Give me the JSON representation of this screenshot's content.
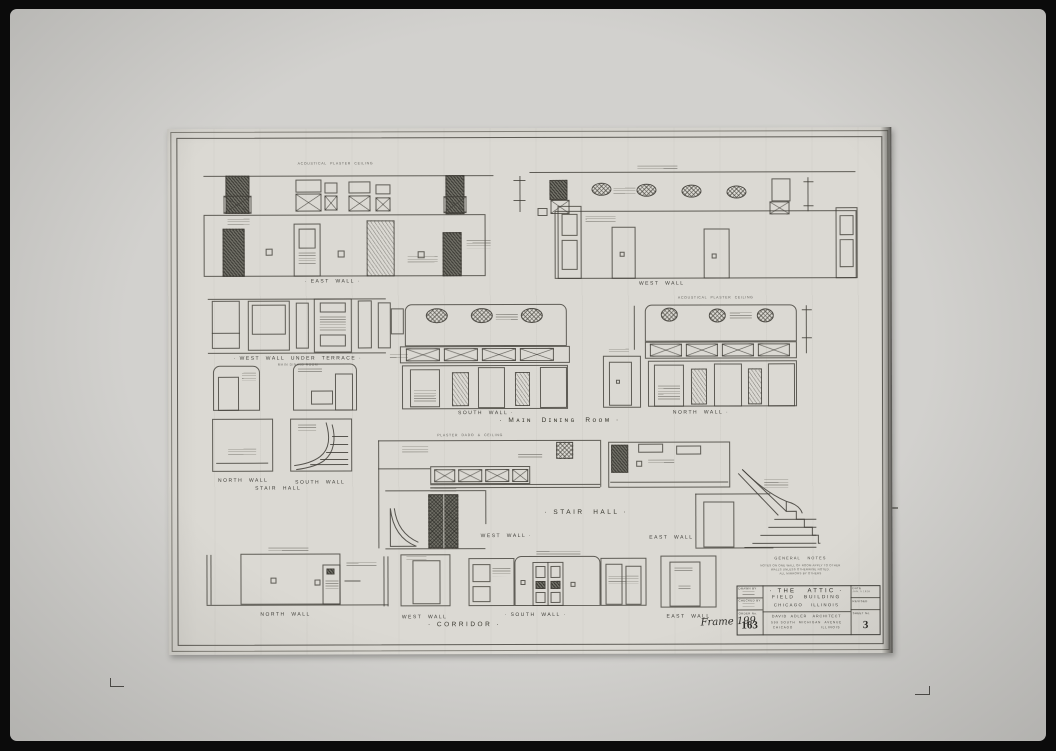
{
  "colors": {
    "photo_frame": "#0b0b0b",
    "photo_field": "#d2d1ce",
    "sheet_paper": "#dbd9d3",
    "ink": "#3e3d38"
  },
  "drawings": {
    "main_dining_room": {
      "title": "· Mᴀɪɴ  Dɪɴɪɴɢ  Rᴏᴏᴍ ·",
      "east_wall": "· EAST  WALL ·",
      "west_wall": "WEST  WALL",
      "west_wall_under_terrace": "· WEST  WALL  UNDER  TERRACE ·",
      "west_wall_under_terrace_sub": "MAIN DINING ROOM",
      "south_wall": "SOUTH  WALL ·",
      "north_wall": "NORTH  WALL ·"
    },
    "stair_hall": {
      "title": "· STAIR  HALL ·",
      "small_title": "STAIR  HALL",
      "north_wall": "NORTH  WALL",
      "south_wall": "SOUTH  WALL",
      "west_wall": "WEST  WALL ·",
      "east_wall": "EAST  WALL"
    },
    "corridor": {
      "title": "· CORRIDOR ·",
      "north_wall": "NORTH  WALL",
      "west_wall": "WEST  WALL",
      "south_wall": "· SOUTH  WALL ·",
      "east_wall": "EAST  WALL"
    }
  },
  "annotations": {
    "acoustical_ceiling": "ACOUSTICAL  PLASTER  CEILING",
    "plaster_dado": "PLASTER  DADO  &  CEILING"
  },
  "general_notes": {
    "title": "GENERAL   NOTES",
    "line1": "NOTES ON ONE WALL OF ROOM APPLY TO OTHER",
    "line2": "WALLS UNLESS OTHERWISE NOTED.",
    "line3": "ALL MIRRORS BY OTHERS"
  },
  "handwritten_note": "Frame 199",
  "title_block": {
    "drawn_by_label": "DRAWN BY",
    "checked_label": "CHECKED BY",
    "order_label": "ORDER No.",
    "order_value": "163",
    "project_line1": "· THE   ATTIC ·",
    "project_line2": "FIELD   BUILDING",
    "project_line3": "CHICAGO   ILLINOIS",
    "architect_line1": "DAVID  ADLER   ARCHITECT",
    "architect_line2": "599 SOUTH  MICHIGAN  AVENUE",
    "architect_line3": "CHICAGO                ILLINOIS",
    "date_label": "DATE",
    "date_value": "JAN. 5 1928",
    "revised_label": "REVISED",
    "sheet_label": "SHEET No.",
    "sheet_value": "3"
  }
}
